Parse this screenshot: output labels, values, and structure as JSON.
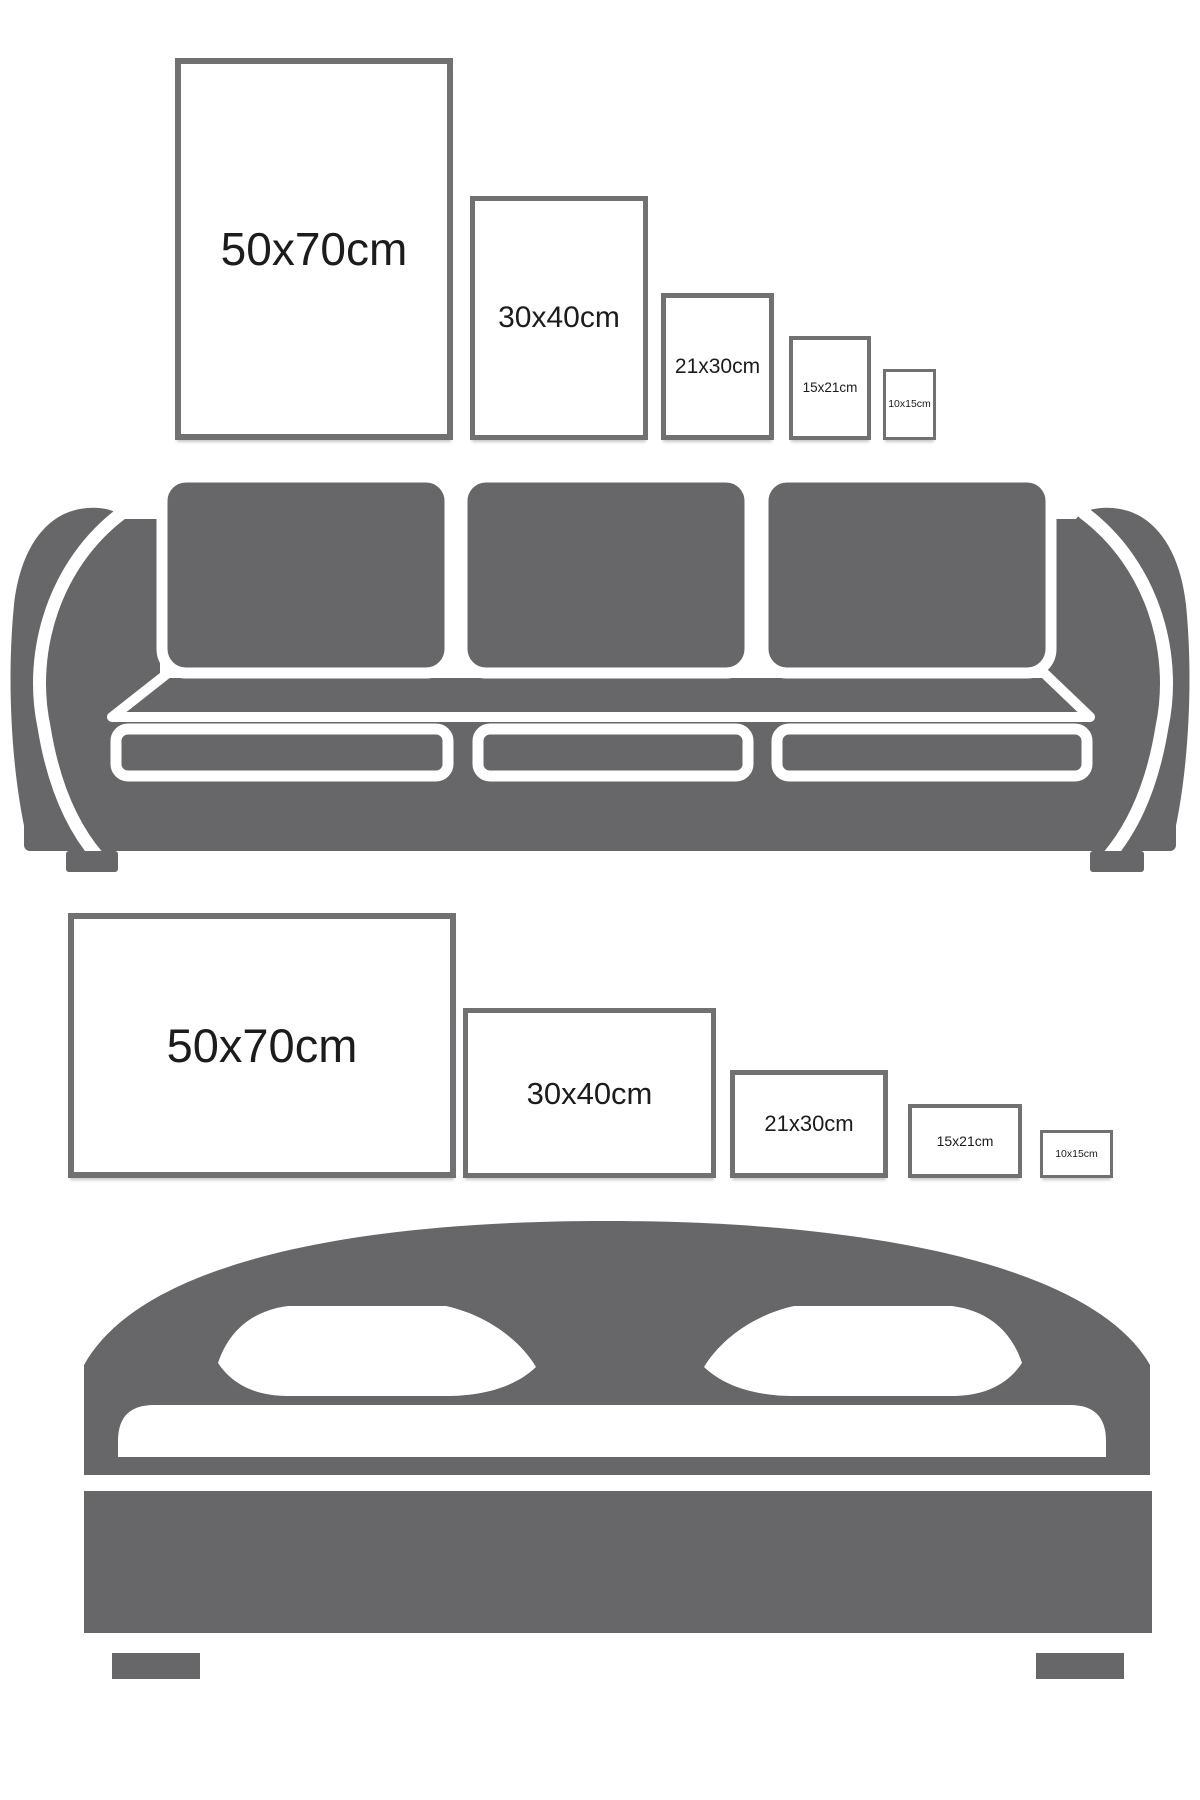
{
  "canvas": {
    "background": "#ffffff"
  },
  "colors": {
    "figure_gray": "#67676a",
    "frame_border": "#717173",
    "label_text": "#1c1c1c"
  },
  "sections": {
    "sofa": {
      "furniture": "sofa",
      "frame_orientation": "portrait",
      "frames": [
        {
          "label": "50x70cm"
        },
        {
          "label": "30x40cm"
        },
        {
          "label": "21x30cm"
        },
        {
          "label": "15x21cm"
        },
        {
          "label": "10x15cm"
        }
      ]
    },
    "bed": {
      "furniture": "bed",
      "frame_orientation": "landscape",
      "frames": [
        {
          "label": "50x70cm"
        },
        {
          "label": "30x40cm"
        },
        {
          "label": "21x30cm"
        },
        {
          "label": "15x21cm"
        },
        {
          "label": "10x15cm"
        }
      ]
    }
  }
}
